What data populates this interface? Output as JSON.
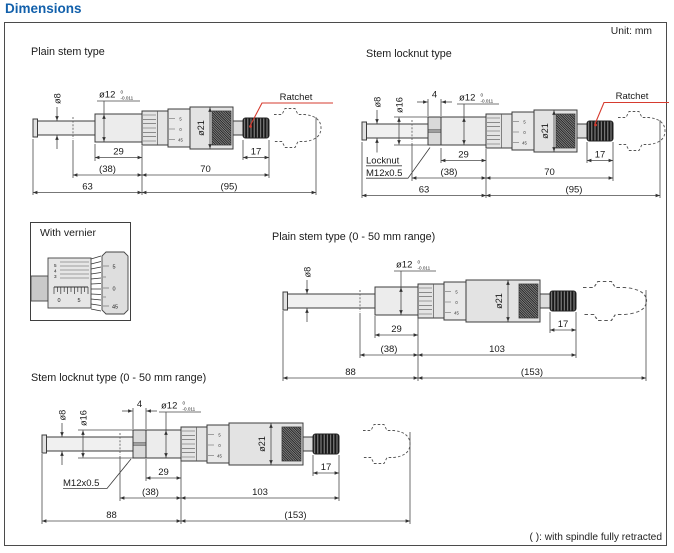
{
  "page": {
    "title": "Dimensions",
    "unit": "Unit: mm",
    "footnote": "( ): with spindle fully retracted"
  },
  "colors": {
    "title_blue": "#1260ab",
    "leader_red": "#d63b2f"
  },
  "shared": {
    "ratchet": "Ratchet",
    "dia21": "ø21",
    "dia12": "ø12",
    "dia12_tol_top": "0",
    "dia12_tol_bot": "-0.011",
    "dia8": "ø8",
    "dia16": "ø16",
    "sleeve_marks": [
      "5",
      "0",
      "45"
    ]
  },
  "drawings": {
    "plain": {
      "title": "Plain stem type",
      "d29": "29",
      "d38": "(38)",
      "d70": "70",
      "d17": "17",
      "d63": "63",
      "d95": "(95)"
    },
    "locknut": {
      "title": "Stem locknut type",
      "d4": "4",
      "locknut1": "Locknut",
      "locknut2": "M12x0.5",
      "d29": "29",
      "d38": "(38)",
      "d70": "70",
      "d17": "17",
      "d63": "63",
      "d95": "(95)"
    },
    "plain50": {
      "title": "Plain stem type (0 - 50 mm range)",
      "d29": "29",
      "d38": "(38)",
      "d103": "103",
      "d17": "17",
      "d88": "88",
      "d153": "(153)"
    },
    "locknut50": {
      "title": "Stem locknut type (0 - 50 mm range)",
      "locknut": "M12x0.5",
      "d4": "4",
      "d29": "29",
      "d38": "(38)",
      "d103": "103",
      "d17": "17",
      "d88": "88",
      "d153": "(153)"
    }
  },
  "vernier": {
    "title": "With vernier",
    "vernier_digits": [
      "5",
      "4",
      "3"
    ],
    "ruler_digits": [
      "0",
      "5"
    ],
    "thimble_digits": [
      "5",
      "0",
      "45"
    ]
  }
}
